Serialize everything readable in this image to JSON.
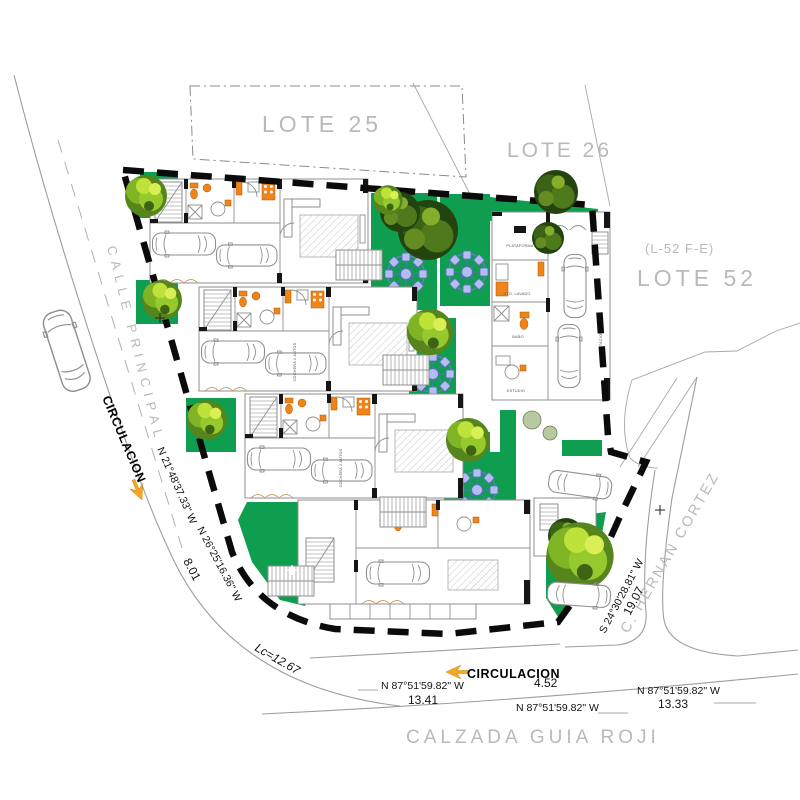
{
  "site": {
    "lots": {
      "lote25": "LOTE 25",
      "lote26": "LOTE 26",
      "lote52": "LOTE 52",
      "lote52_code": "(L-52 F-E)"
    },
    "streets": {
      "calle_principal": "CALLE PRINCIPAL",
      "calzada": "CALZADA GUIA ROJI",
      "hernan_cortez": "C. HERNAN CORTEZ"
    },
    "circulation": {
      "left": "CIRCULACION",
      "bottom": "CIRCULACION"
    },
    "bearings": {
      "left_1": "N 21°48'37.33\" W",
      "left_2": "N 26°25'16.36\" W",
      "left_dist": "8.01",
      "curve": "Lc=12.67",
      "bottom_1": "N 87°51'59.82\" W",
      "bottom_1_dist": "13.41",
      "bottom_2_dist": "4.52",
      "bottom_2": "N 87°51'59.82\" W",
      "bottom_3": "N 87°51'59.82\" W",
      "bottom_3_dist": "13.33",
      "right": "S 24°30'28.81\" W",
      "right_dist": "19.07"
    },
    "rooms": {
      "plataforma": "PLATAFORMA",
      "cto_lavado": "CTO. LAVADO",
      "bano": "BAÑO",
      "estudio": "ESTUDIO",
      "estacionamiento": "ESTACIONAMIENTO",
      "cochera": "COCHERA 2 AUTOS"
    },
    "colors": {
      "lawn": "#0f9e4f",
      "fixture_orange": "#f08418",
      "arrow_orange": "#f6a61f",
      "table_blue": "#b3bdf0",
      "cad_gray_text": "#b9b9b9",
      "boundary_black": "#0b0b0b"
    }
  }
}
